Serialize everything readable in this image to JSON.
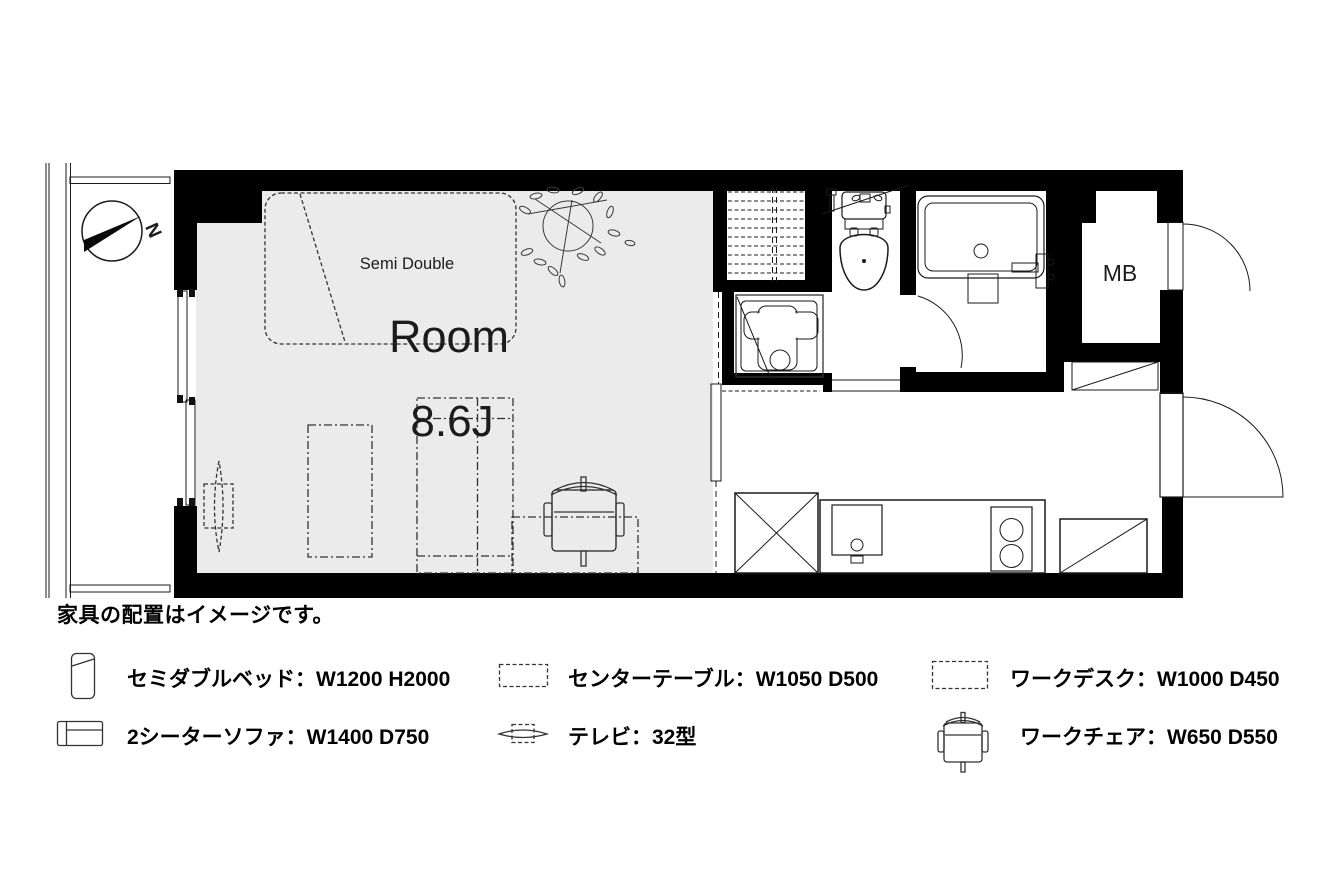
{
  "plan": {
    "room_label": "Room",
    "room_size_label": "8.6J",
    "bed_size_label": "Semi Double",
    "meter_box_label": "MB",
    "compass_north_label": "N"
  },
  "note": "家具の配置はイメージです。",
  "legend": {
    "items": [
      {
        "id": "bed",
        "label": "セミダブルベッド：W1200 H2000"
      },
      {
        "id": "sofa",
        "label": "2シーターソファ：W1400 D750"
      },
      {
        "id": "center-table",
        "label": "センターテーブル：W1050 D500"
      },
      {
        "id": "tv",
        "label": "テレビ：32型"
      },
      {
        "id": "desk",
        "label": "ワークデスク：W1000 D450"
      },
      {
        "id": "chair",
        "label": "ワークチェア：W650 D550"
      }
    ]
  },
  "colors": {
    "floor": "#ebebeb",
    "wall": "#000000",
    "line": "#1a1a1a",
    "furniture_line": "#333333"
  }
}
